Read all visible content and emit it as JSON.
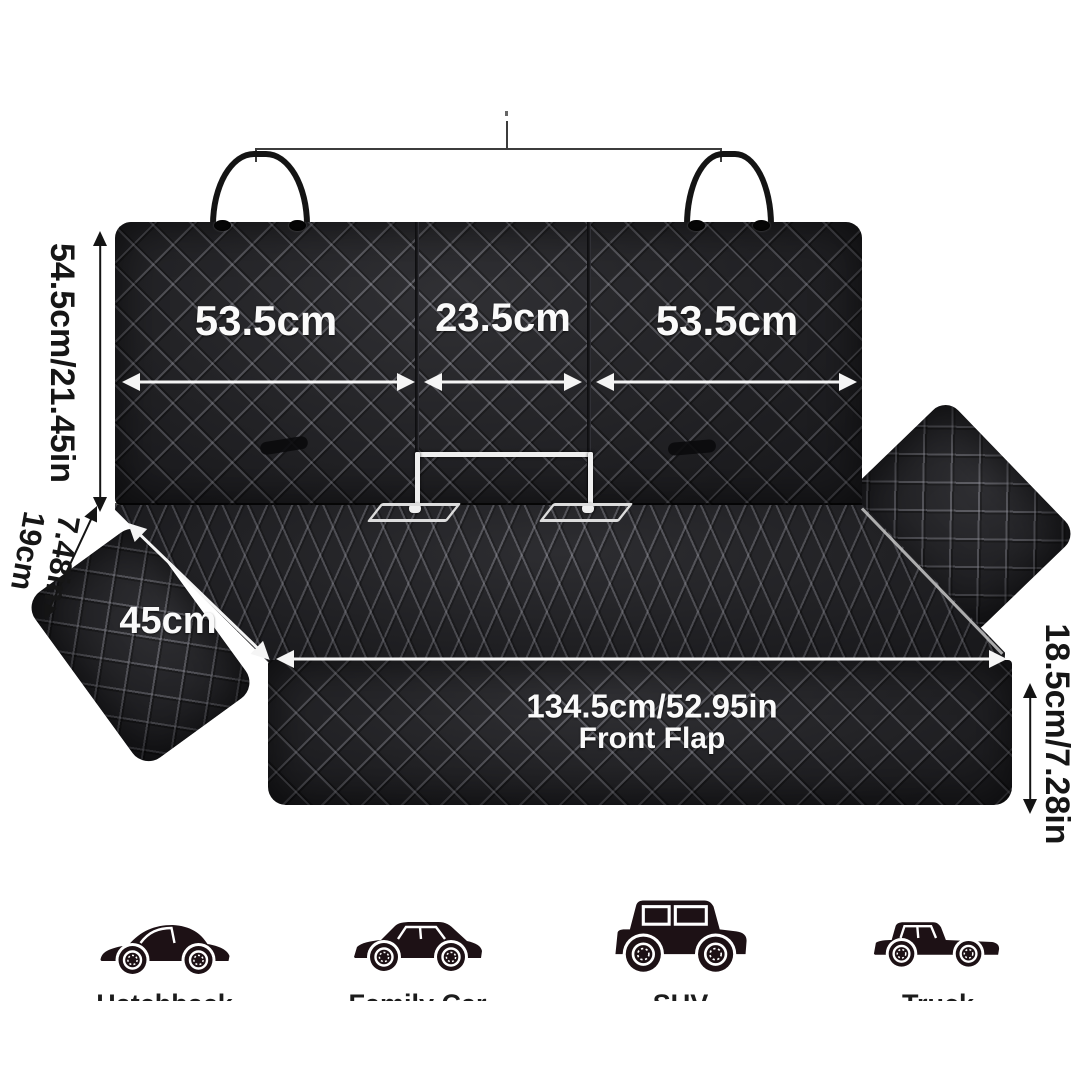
{
  "diagram_title": "pet car seat cover dimensions",
  "dims": {
    "back_width_left": "53.5cm",
    "back_width_middle": "23.5cm",
    "back_width_right": "53.5cm",
    "back_height": "54.5cm/21.45in",
    "side_depth_cm": "19cm",
    "side_depth_in": "7.48in",
    "seat_depth": "45cm",
    "front_width": "134.5cm/52.95in",
    "front_flap_label": "Front Flap",
    "front_height": "18.5cm/7.28in"
  },
  "vehicles": [
    {
      "label": "Hatchback"
    },
    {
      "label": "Family Car"
    },
    {
      "label": "SUV"
    },
    {
      "label": "Truck"
    }
  ],
  "colors": {
    "fabric": "#232327",
    "quilt_line": "#96969f",
    "annotation_on_fabric": "#fafafa",
    "annotation_on_white": "#161616",
    "vehicle_silhouette": "#1d1115",
    "background": "#ffffff"
  }
}
